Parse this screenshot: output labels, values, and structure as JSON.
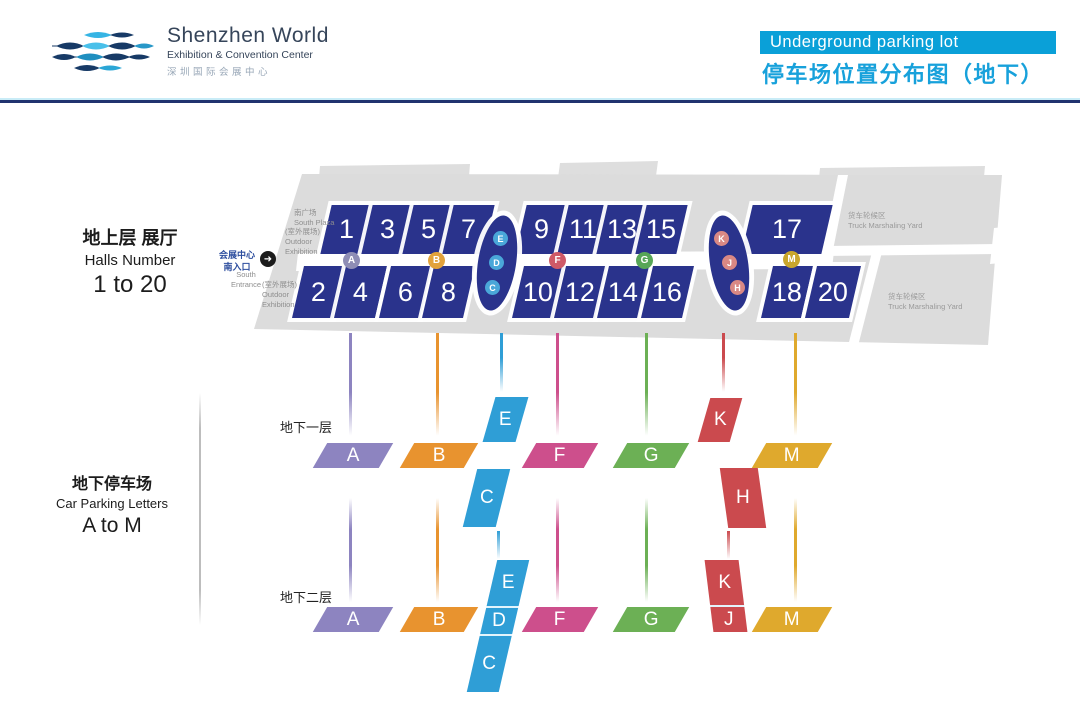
{
  "header": {
    "logo_title": "Shenzhen World",
    "logo_subtitle": "Exhibition &amp; Convention Center",
    "logo_subtitle_plain": "Exhibition & Convention Center",
    "logo_cn": "深圳国际会展中心",
    "banner": "Underground parking lot",
    "title_cn": "停车场位置分布图（地下）"
  },
  "legend": {
    "halls_cn": "地上层 展厅",
    "halls_en": "Halls Number",
    "halls_range": "1 to 20",
    "parking_cn": "地下停车场",
    "parking_en": "Car Parking Letters",
    "parking_range": "A to M"
  },
  "map": {
    "south_plaza_cn": "南广场",
    "south_plaza_en": "South Plaza",
    "outdoor_cn": "(室外展场)",
    "outdoor_en_1": "Outdoor",
    "outdoor_en_2": "Exhibition",
    "entrance_cn_1": "会展中心",
    "entrance_cn_2": "南入口",
    "entrance_en_1": "South",
    "entrance_en_2": "Entrance",
    "truck_yard_cn": "货车轮候区",
    "truck_yard_en": "Truck Marshaling Yard",
    "halls_row1": [
      "1",
      "3",
      "5",
      "7",
      "9",
      "11",
      "13",
      "15",
      "17"
    ],
    "halls_row2": [
      "2",
      "4",
      "6",
      "8",
      "10",
      "12",
      "14",
      "16",
      "18",
      "20"
    ],
    "badges": [
      "A",
      "B",
      "F",
      "G",
      "M"
    ],
    "oval_edc": [
      "E",
      "D",
      "C"
    ],
    "oval_kjh": [
      "K",
      "J",
      "H"
    ]
  },
  "levels": {
    "b1_label": "地下一层",
    "b2_label": "地下二层",
    "b1_zones": [
      "A",
      "B",
      "E",
      "C",
      "F",
      "G",
      "K",
      "H",
      "M"
    ],
    "b2_zones": [
      "A",
      "B",
      "E",
      "D",
      "C",
      "F",
      "G",
      "K",
      "J",
      "M"
    ]
  },
  "colors": {
    "banner_bg": "#0aa0d8",
    "title_cn": "#17a1db",
    "hall_navy": "#2a338c",
    "zone_a": "#8d84c0",
    "zone_b": "#e8932f",
    "zone_cde": "#2f9ed6",
    "zone_f": "#cd4f8c",
    "zone_g": "#6cb055",
    "zone_hjk": "#cb4a4e",
    "zone_m": "#dfa92d",
    "map_gray": "#dcdcdc"
  }
}
